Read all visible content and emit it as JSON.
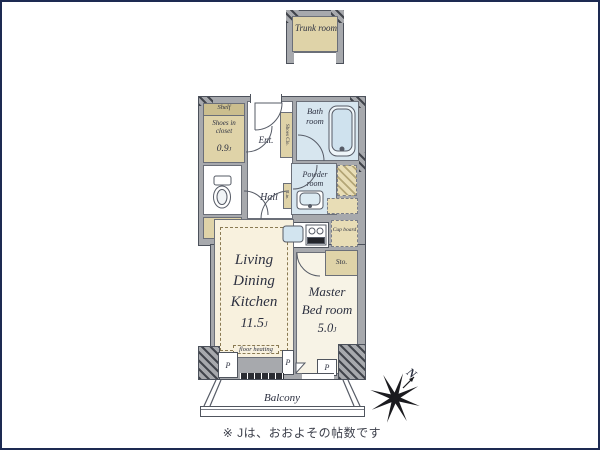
{
  "trunk_room": {
    "label": "Trunk room"
  },
  "rooms": {
    "shelf": "Shelf",
    "shoes_in_closet": {
      "name": "Shoes in closet",
      "area_value": "0.9",
      "unit": "J"
    },
    "sto": "Sto.",
    "ent": "Ent.",
    "hall": "Hall",
    "shoes_clo": "Shoes Clo.",
    "bath": "Bath room",
    "powder": "Powder room",
    "linen": "Lin.",
    "cupboard": "Cup board",
    "ldk": {
      "line1": "Living",
      "line2": "Dining",
      "line3": "Kitchen",
      "area_value": "11.5",
      "unit": "J"
    },
    "floor_heating": "floor heating",
    "bedroom": {
      "line1": "Master",
      "line2": "Bed room",
      "area_value": "5.0",
      "unit": "J"
    },
    "pillar": "P",
    "balcony": "Balcony"
  },
  "compass": {
    "north": "N"
  },
  "footnote": "※ Jは、おおよその帖数です",
  "colors": {
    "frame": "#1d2a52",
    "wall": "#a7a9ad",
    "wall_line": "#4c515b",
    "floor_cream": "#f8f1de",
    "closet_beige": "#dfd3a8",
    "wet_blue": "#d7e6ef",
    "text": "#2c3040"
  }
}
